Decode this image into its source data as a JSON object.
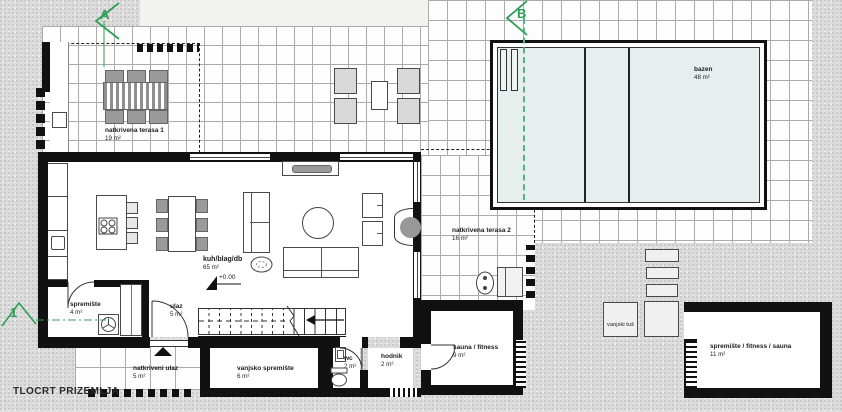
{
  "title": "TLOCRT PRIZEMLJA",
  "markers": {
    "a": "A",
    "b": "B",
    "cut1": "1"
  },
  "annotations": {
    "elevation": "+0.00"
  },
  "rooms": [
    {
      "name": "natkrivena terasa 1",
      "area": "19 m²"
    },
    {
      "name": "natkrivena terasa 2",
      "area": "16 m²"
    },
    {
      "name": "bazen",
      "area": "48 m²"
    },
    {
      "name": "kuh/blag/db",
      "area": "65 m²"
    },
    {
      "name": "spremište",
      "area": "4 m²"
    },
    {
      "name": "ulaz",
      "area": "5 m²"
    },
    {
      "name": "natkriveni ulaz",
      "area": "5 m²"
    },
    {
      "name": "vanjsko spremište",
      "area": "6 m²"
    },
    {
      "name": "wc",
      "area": "2 m²"
    },
    {
      "name": "hodnik",
      "area": "2 m²"
    },
    {
      "name": "sauna / fitness",
      "area": "9 m²"
    },
    {
      "name": "vanjski tuš",
      "area": ""
    },
    {
      "name": "spremište / fitness / sauna",
      "area": "11 m²"
    }
  ],
  "colors": {
    "wall": "#111111",
    "tile_line": "#ababab",
    "pool_water": "#e7efee",
    "section_green": "#2e9e56",
    "background": "#dcdcdc"
  }
}
